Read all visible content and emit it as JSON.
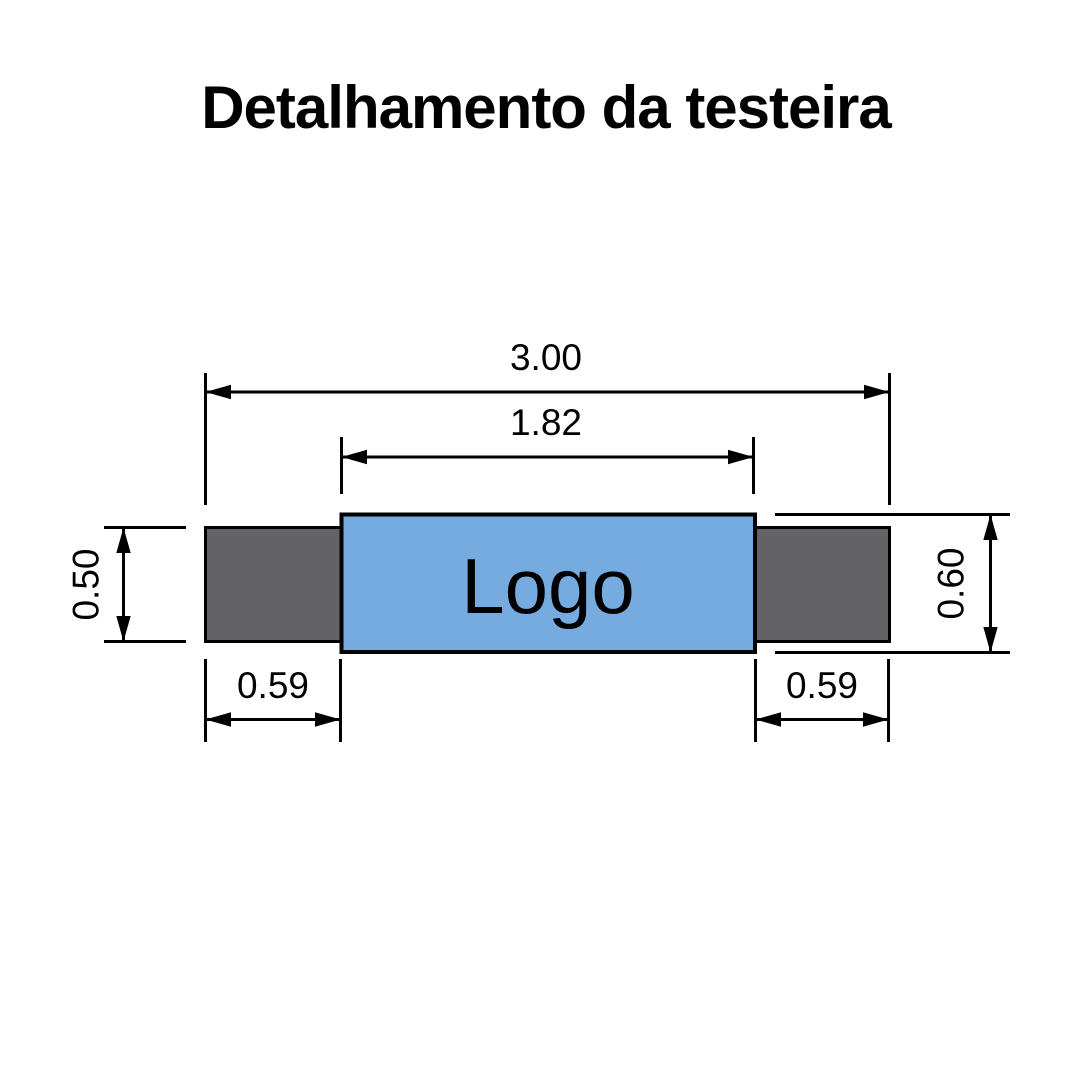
{
  "title": "Detalhamento da testeira",
  "diagram": {
    "logo_label": "Logo",
    "colors": {
      "background": "#ffffff",
      "logo_panel_fill": "#76ABDF",
      "side_panel_fill": "#636366",
      "line": "#000000",
      "text": "#000000"
    },
    "dimensions": {
      "total_width": "3.00",
      "logo_width": "1.82",
      "side_panel_height": "0.50",
      "logo_panel_height": "0.60",
      "left_panel_width": "0.59",
      "right_panel_width": "0.59"
    }
  }
}
